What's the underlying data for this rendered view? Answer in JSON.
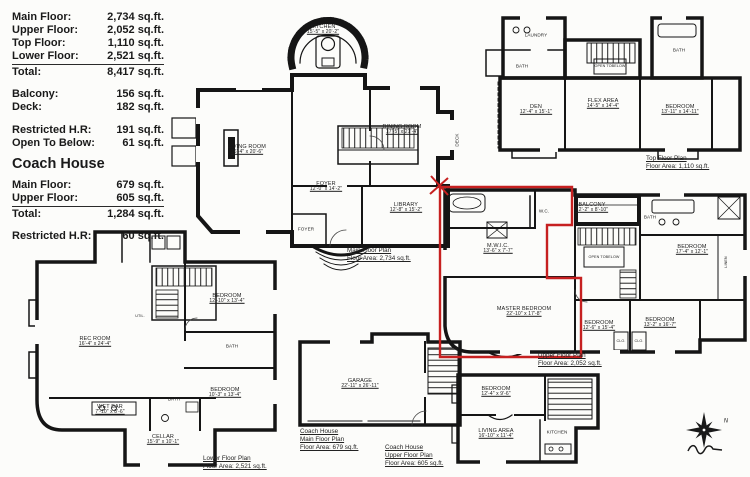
{
  "legend": {
    "house": [
      {
        "label": "Main Floor:",
        "value": "2,734 sq.ft."
      },
      {
        "label": "Upper Floor:",
        "value": "2,052 sq.ft."
      },
      {
        "label": "Top Floor:",
        "value": "1,110 sq.ft."
      },
      {
        "label": "Lower Floor:",
        "value": "2,521 sq.ft."
      },
      {
        "label": "Total:",
        "value": "8,417 sq.ft."
      }
    ],
    "outdoor": [
      {
        "label": "Balcony:",
        "value": "156 sq.ft."
      },
      {
        "label": "Deck:",
        "value": "182 sq.ft."
      }
    ],
    "restricted": [
      {
        "label": "Restricted H.R:",
        "value": "191 sq.ft."
      },
      {
        "label": "Open To Below:",
        "value": "61 sq.ft."
      }
    ],
    "coach_house_heading": "Coach House",
    "coach": [
      {
        "label": "Main Floor:",
        "value": "679 sq.ft."
      },
      {
        "label": "Upper Floor:",
        "value": "605 sq.ft."
      },
      {
        "label": "Total:",
        "value": "1,284 sq.ft."
      }
    ],
    "coach_restricted": {
      "label": "Restricted H.R:",
      "value": "60 sq.ft."
    }
  },
  "plans": {
    "main": {
      "caption": {
        "line1": "Main Floor Plan",
        "line2": "Floor Area: 2,734 sq.ft."
      },
      "rooms": {
        "kitchen": {
          "name": "KITCHEN",
          "dims": "15'-5\" x 20'-2\""
        },
        "living_room": {
          "name": "LIVING ROOM",
          "dims": "16'-4\" x 20'-6\""
        },
        "dining_room": {
          "name": "DINING ROOM",
          "dims": "17'-5\" x 21'-4\""
        },
        "foyer": {
          "name": "FOYER",
          "dims": "12'-0\" x 14'-2\""
        },
        "library": {
          "name": "LIBRARY",
          "dims": "12'-8\" x 15'-2\""
        },
        "foyer_small": {
          "name": "FOYER"
        },
        "deck": {
          "name": "DECK"
        }
      }
    },
    "top": {
      "caption": {
        "line1": "Top Floor Plan",
        "line2": "Floor Area: 1,110 sq.ft."
      },
      "rooms": {
        "laundry": {
          "name": "LAUNDRY"
        },
        "bath_left": {
          "name": "BATH"
        },
        "den": {
          "name": "DEN",
          "dims": "12'-4\" x 15'-1\""
        },
        "flex_area": {
          "name": "FLEX AREA",
          "dims": "14'-5\" x 14'-4\""
        },
        "bedroom": {
          "name": "BEDROOM",
          "dims": "13'-11\" x 14'-11\""
        },
        "bath_right": {
          "name": "BATH"
        },
        "open_to_below": {
          "line1": "OPEN TO",
          "line2": "BELOW"
        }
      }
    },
    "upper": {
      "caption": {
        "line1": "Upper Floor Plan",
        "line2": "Floor Area: 2,052 sq.ft."
      },
      "rooms": {
        "mwic": {
          "name": "M.W.I.C.",
          "dims": "13'-6\" x 7'-7\""
        },
        "master_bedroom": {
          "name": "MASTER BEDROOM",
          "dims": "22'-10\" x 17'-8\""
        },
        "wc": {
          "name": "W.C."
        },
        "balcony": {
          "name": "BALCONY",
          "dims": "12'-2\" x 8'-10\""
        },
        "open_to_below": {
          "line1": "OPEN TO",
          "line2": "BELOW"
        },
        "bedroom_ne": {
          "name": "BEDROOM",
          "dims": "17'-4\" x 12'-1\""
        },
        "bath": {
          "name": "BATH"
        },
        "bedroom_s1": {
          "name": "BEDROOM",
          "dims": "12'-6\" x 15'-4\""
        },
        "bedroom_s2": {
          "name": "BEDROOM",
          "dims": "13'-2\" x 16'-7\""
        },
        "closet1": {
          "name": "CLO."
        },
        "closet2": {
          "name": "CLO."
        },
        "linen": {
          "name": "LINEN"
        }
      }
    },
    "lower": {
      "caption": {
        "line1": "Lower Floor Plan",
        "line2": "Floor Area: 2,521 sq.ft."
      },
      "rooms": {
        "rec_room": {
          "name": "REC ROOM",
          "dims": "16'-4\" x 24'-4\""
        },
        "bedroom_top": {
          "name": "BEDROOM",
          "dims": "12'-10\" x 13'-4\""
        },
        "bath1": {
          "name": "BATH"
        },
        "bedroom_bottom": {
          "name": "BEDROOM",
          "dims": "10'-3\" x 13'-4\""
        },
        "wet_bar": {
          "name": "WET BAR",
          "dims": "7'-10\" x 8'-6\""
        },
        "bath2": {
          "name": "BATH"
        },
        "cellar": {
          "name": "CELLAR",
          "dims": "15'-9\" x 10'-1\""
        },
        "util": {
          "name": "UTIL."
        }
      }
    },
    "coach_main": {
      "caption": {
        "line1": "Coach House",
        "line2": "Main Floor Plan",
        "line3": "Floor Area: 679 sq.ft."
      },
      "rooms": {
        "garage": {
          "name": "GARAGE",
          "dims": "22'-11\" x 26'-11\""
        }
      }
    },
    "coach_upper": {
      "caption": {
        "line1": "Coach House",
        "line2": "Upper Floor Plan",
        "line3": "Floor Area: 605 sq.ft."
      },
      "rooms": {
        "bedroom": {
          "name": "BEDROOM",
          "dims": "12'-4\" x 9'-6\""
        },
        "living_area": {
          "name": "LIVING AREA",
          "dims": "16'-10\" x 11'-4\""
        },
        "kitchen": {
          "name": "KITCHEN"
        }
      }
    }
  },
  "compass": {
    "north": "N"
  },
  "highlight": {
    "color": "#c62020"
  }
}
